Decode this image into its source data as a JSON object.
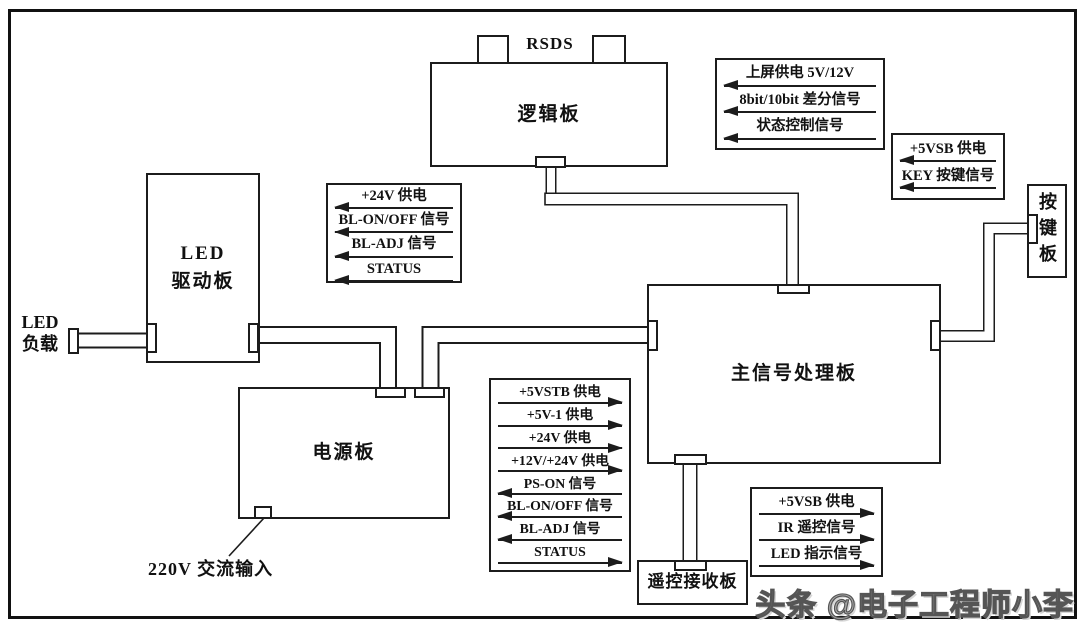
{
  "boards": {
    "logic": {
      "label": "逻辑板"
    },
    "led_driver": {
      "line1": "LED",
      "line2": "驱动板"
    },
    "power": {
      "label": "电源板"
    },
    "main": {
      "label": "主信号处理板"
    },
    "remote": {
      "label": "遥控接收板"
    },
    "keypad": {
      "label": "按键板"
    }
  },
  "labels": {
    "rsds": "RSDS",
    "led_load_line1": "LED",
    "led_load_line2": "负载",
    "ac_input": "220V 交流输入",
    "watermark": "头条 @电子工程师小李"
  },
  "annotations": {
    "logic_main": {
      "rows": [
        {
          "text": "上屏供电 5V/12V",
          "dir": "left"
        },
        {
          "text": "8bit/10bit 差分信号",
          "dir": "left"
        },
        {
          "text": "状态控制信号",
          "dir": "left"
        }
      ]
    },
    "key_main": {
      "rows": [
        {
          "text": "+5VSB 供电",
          "dir": "left"
        },
        {
          "text": "KEY 按键信号",
          "dir": "left"
        }
      ]
    },
    "backlight": {
      "rows": [
        {
          "text": "+24V 供电",
          "dir": "left"
        },
        {
          "text": "BL-ON/OFF 信号",
          "dir": "left"
        },
        {
          "text": "BL-ADJ 信号",
          "dir": "left"
        },
        {
          "text": "STATUS",
          "dir": "left"
        }
      ]
    },
    "power_main": {
      "rows": [
        {
          "text": "+5VSTB 供电",
          "dir": "right"
        },
        {
          "text": "+5V-1 供电",
          "dir": "right"
        },
        {
          "text": "+24V 供电",
          "dir": "right"
        },
        {
          "text": "+12V/+24V 供电",
          "dir": "right"
        },
        {
          "text": "PS-ON 信号",
          "dir": "left"
        },
        {
          "text": "BL-ON/OFF 信号",
          "dir": "left"
        },
        {
          "text": "BL-ADJ 信号",
          "dir": "left"
        },
        {
          "text": "STATUS",
          "dir": "right"
        }
      ]
    },
    "remote_main": {
      "rows": [
        {
          "text": "+5VSB 供电",
          "dir": "right"
        },
        {
          "text": "IR 遥控信号",
          "dir": "right"
        },
        {
          "text": "LED 指示信号",
          "dir": "right"
        }
      ]
    }
  },
  "colors": {
    "line": "#1c1c1c",
    "background": "#ffffff",
    "watermark": "#a9a9a9"
  }
}
